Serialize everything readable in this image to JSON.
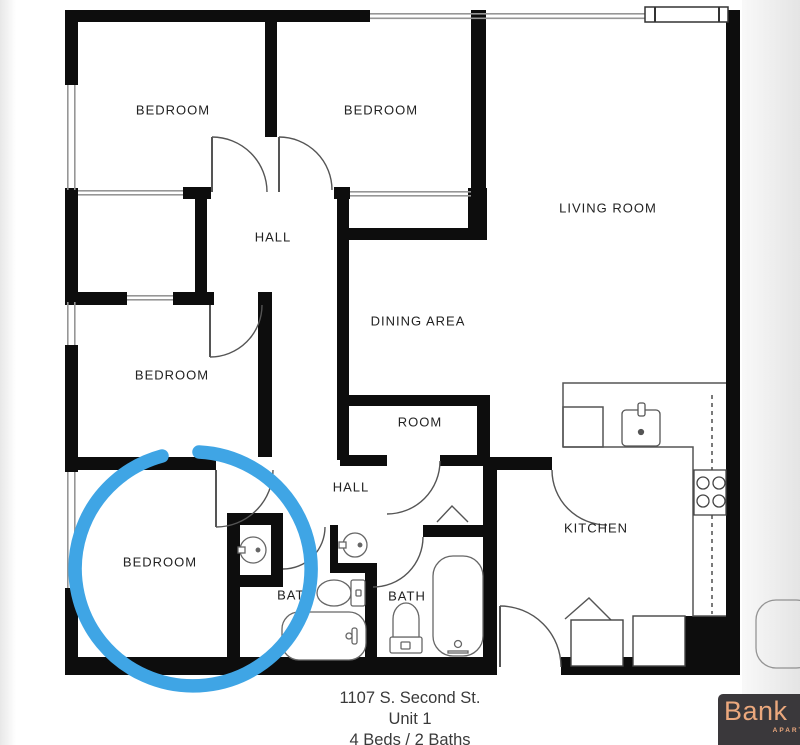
{
  "floor_plan": {
    "rooms": {
      "bedroom_top_left": "BEDROOM",
      "bedroom_top_middle": "BEDROOM",
      "living_room": "LIVING ROOM",
      "hall_upper": "HALL",
      "dining_area": "DINING AREA",
      "bedroom_middle_left": "BEDROOM",
      "room": "ROOM",
      "hall_lower": "HALL",
      "bedroom_bottom_left": "BEDROOM",
      "bath_left": "BATH",
      "bath_right": "BATH",
      "kitchen": "KITCHEN"
    },
    "wall_color": "#0d0d0d",
    "fixture_line_color": "#555555"
  },
  "annotation": {
    "type": "hand-drawn-circle",
    "color": "#3fa5e5",
    "highlights": "bottom-left bedroom"
  },
  "footer": {
    "address": "1107 S. Second St.",
    "unit": "Unit 1",
    "beds_baths": "4 Beds / 2 Baths"
  },
  "logo": {
    "name": "Bank",
    "subtext": "APARTM",
    "bg": "#3a383b",
    "text_color": "#eba87d"
  }
}
